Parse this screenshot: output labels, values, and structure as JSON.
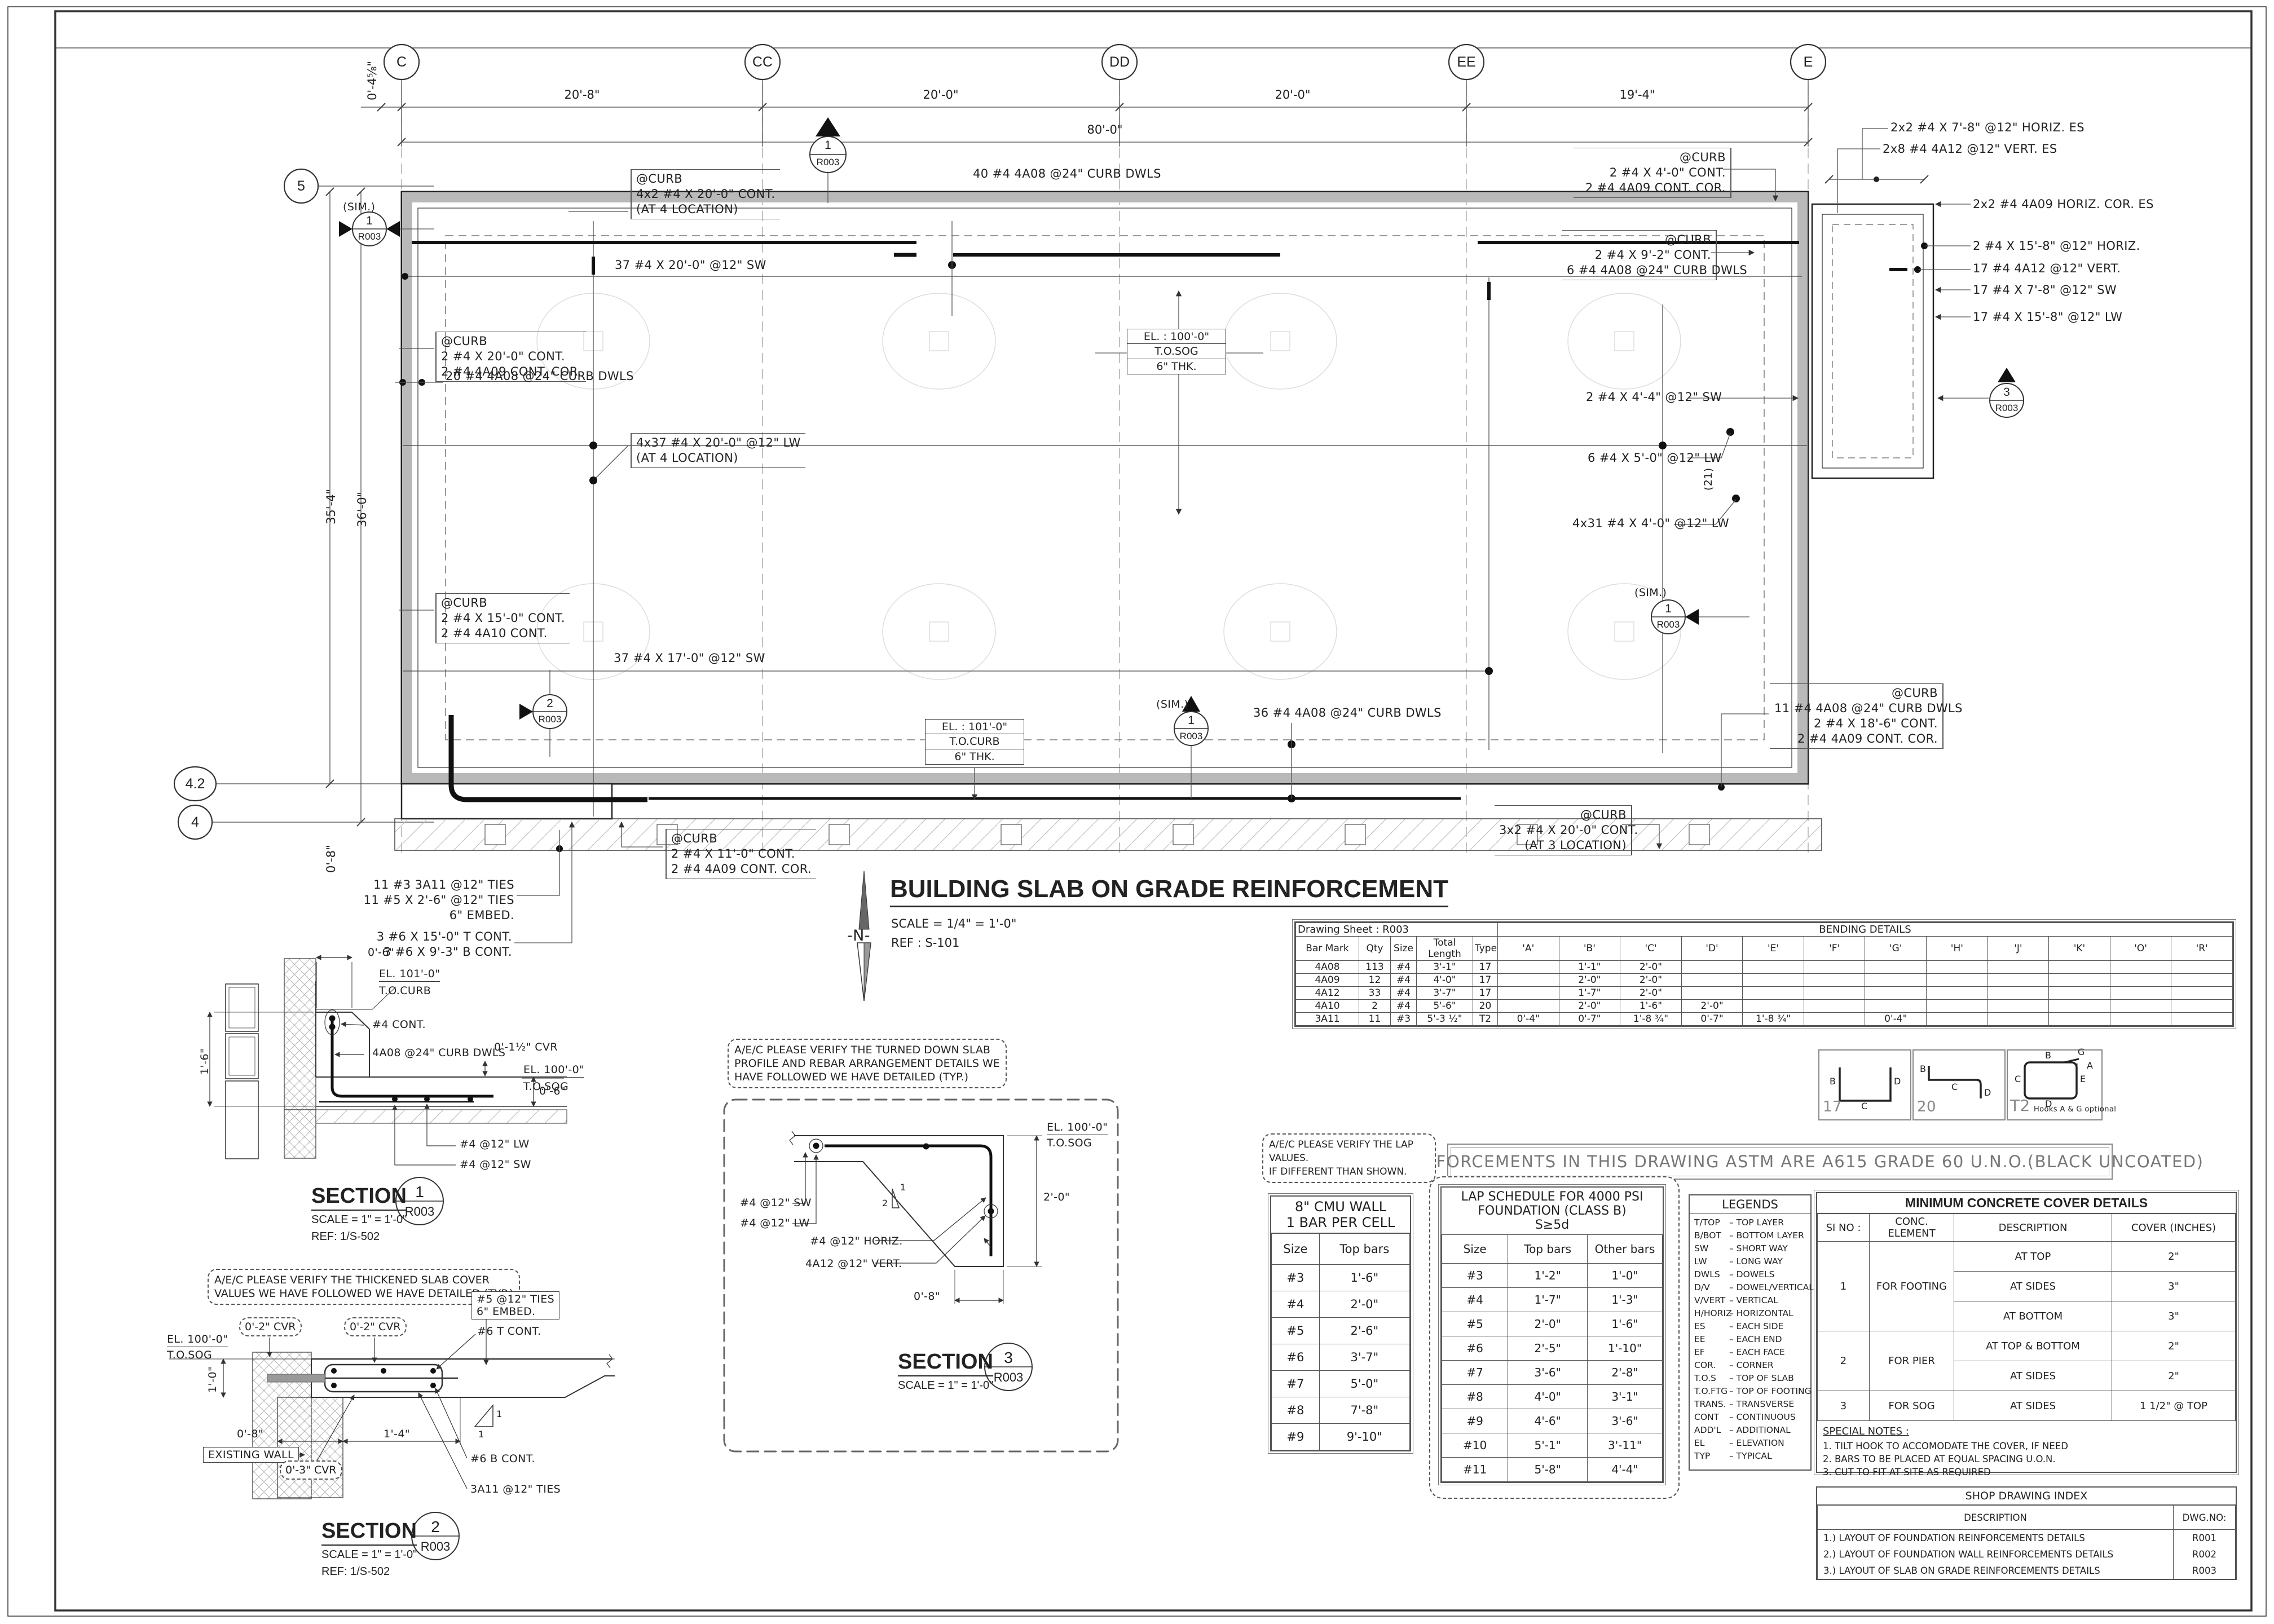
{
  "colors": {
    "curb_gray": "#b9b9b9",
    "hatch": "#aaaaaa",
    "line": "#222222"
  },
  "sheet": {
    "grid_top": [
      "C",
      "CC",
      "DD",
      "EE",
      "E"
    ],
    "grid_left": [
      "5",
      "4.2",
      "4"
    ],
    "dims_top": {
      "d0": "0'-4⅝\"",
      "d1": "20'-8\"",
      "d2": "20'-0\"",
      "d3": "20'-0\"",
      "d4": "19'-4\"",
      "overall": "80'-0\""
    },
    "dims_left": {
      "d1": "35'-4\"",
      "d2": "36'-0\"",
      "d3": "0'-8\""
    }
  },
  "plan": {
    "title": "BUILDING SLAB ON GRADE REINFORCEMENT",
    "scale": "SCALE = 1/4\" = 1'-0\"",
    "ref": "REF : S-101",
    "north": "-N-",
    "sim": "(SIM.)",
    "rot21": "(21)",
    "flag": {
      "n1": "1",
      "n2": "2",
      "n3": "3",
      "sheet": "R003"
    },
    "el_sog": {
      "l1": "EL. : 100'-0\"",
      "l2": "T.O.SOG",
      "l3": "6\" THK."
    },
    "el_curb": {
      "l1": "EL. : 101'-0\"",
      "l2": "T.O.CURB",
      "l3": "6\" THK."
    },
    "notes": {
      "curb_tl": {
        "lines": [
          "@CURB",
          "4x2 #4 X 20'-0\" CONT.",
          "(AT 4 LOCATION)"
        ]
      },
      "dwls_top": "40 #4 4A08 @24\" CURB DWLS",
      "curb_tr": {
        "lines": [
          "@CURB",
          "2 #4 X 4'-0\" CONT.",
          "2 #4 4A09 CONT. COR."
        ]
      },
      "horiz_es": "2x2 #4 X 7'-8\" @12\" HORIZ. ES",
      "vert_es": "2x8 #4 4A12 @12\" VERT. ES",
      "cor_es": "2x2 #4 4A09  HORIZ. COR. ES",
      "horiz2": "2 #4 X 15'-8\" @12\" HORIZ.",
      "vert17": "17 #4 4A12 @12\" VERT.",
      "sw17": "17 #4 X 7'-8\"  @12\" SW",
      "lw17": "17 #4 X 15'-8\"  @12\" LW",
      "curb_r": {
        "lines": [
          "@CURB",
          "2 #4 X 9'-2\"  CONT.",
          "6 #4 4A08 @24\" CURB DWLS"
        ]
      },
      "sw2": "2 #4 X 4'-4\"  @12\" SW",
      "lw6": "6 #4 X 5'-0\" @12\" LW",
      "lw4x31": "4x31 #4 X 4'-0\" @12\" LW",
      "curb_l1": {
        "lines": [
          "@CURB",
          "2 #4 X 20'-0\"  CONT.",
          "2 #4 4A09  CONT. COR."
        ]
      },
      "dwls_l": "20 #4 4A08 @24\" CURB DWLS",
      "lw4x37": {
        "lines": [
          "4x37 #4 X 20'-0\"  @12\" LW",
          "(AT 4 LOCATION)"
        ]
      },
      "curb_l2": {
        "lines": [
          "@CURB",
          "2 #4 X 15'-0\"  CONT.",
          "2 #4 4A10  CONT."
        ]
      },
      "sw37a": "37 #4 X 20'-0\"  @12\" SW",
      "sw37b": "37 #4 X 17'-0\"  @12\" SW",
      "dwls_b": "36 #4 4A08 @24\" CURB DWLS",
      "curb_br": {
        "lines": [
          "@CURB",
          "11 #4 4A08 @24\" CURB DWLS",
          "2 #4 X 18'-6\"  CONT.",
          "2 #4 4A09  CONT. COR."
        ]
      },
      "curb_bb": {
        "lines": [
          "@CURB",
          "3x2 #4 X 20'-0\"  CONT.",
          "(AT 3 LOCATION)"
        ]
      },
      "curb_bl": {
        "lines": [
          "@CURB",
          "2 #4 X 11'-0\"  CONT.",
          "2 #4 4A09  CONT. COR."
        ]
      },
      "ties_bl": {
        "lines": [
          "11 #3 3A11 @12\" TIES",
          "11 #5 X 2'-6\" @12\" TIES",
          "6\" EMBED."
        ]
      },
      "cont_bl": {
        "lines": [
          "3 #6 X 15'-0\"  T CONT.",
          "3 #6 X 9'-3\"  B CONT."
        ]
      }
    }
  },
  "bending": {
    "sheet_label": "Drawing Sheet : R003",
    "title": "BENDING DETAILS",
    "headers": [
      "Bar Mark",
      "Qty",
      "Size",
      "Total Length",
      "Type",
      "'A'",
      "'B'",
      "'C'",
      "'D'",
      "'E'",
      "'F'",
      "'G'",
      "'H'",
      "'J'",
      "'K'",
      "'O'",
      "'R'"
    ],
    "rows": [
      [
        "4A08",
        "113",
        "#4",
        "3'-1\"",
        "17",
        "",
        "1'-1\"",
        "2'-0\"",
        "",
        "",
        "",
        "",
        "",
        "",
        "",
        "",
        ""
      ],
      [
        "4A09",
        "12",
        "#4",
        "4'-0\"",
        "17",
        "",
        "2'-0\"",
        "2'-0\"",
        "",
        "",
        "",
        "",
        "",
        "",
        "",
        "",
        ""
      ],
      [
        "4A12",
        "33",
        "#4",
        "3'-7\"",
        "17",
        "",
        "1'-7\"",
        "2'-0\"",
        "",
        "",
        "",
        "",
        "",
        "",
        "",
        "",
        ""
      ],
      [
        "4A10",
        "2",
        "#4",
        "5'-6\"",
        "20",
        "",
        "2'-0\"",
        "1'-6\"",
        "2'-0\"",
        "",
        "",
        "",
        "",
        "",
        "",
        "",
        ""
      ],
      [
        "3A11",
        "11",
        "#3",
        "5'-3 ½\"",
        "T2",
        "0'-4\"",
        "0'-7\"",
        "1'-8 ¾\"",
        "0'-7\"",
        "1'-8 ¾\"",
        "",
        "0'-4\"",
        "",
        "",
        "",
        "",
        ""
      ]
    ]
  },
  "bend_types": {
    "n17": "17",
    "n20": "20",
    "nT2": "T2",
    "t2_note": "Hooks A & G optional",
    "A": "A",
    "B": "B",
    "C": "C",
    "D": "D",
    "E": "E",
    "G": "G"
  },
  "banner": "ALL REINFORCEMENTS IN THIS DRAWING  ASTM ARE A615 GRADE 60 U.N.O.(BLACK UNCOATED)",
  "cloud_lap": {
    "lines": [
      "A/E/C PLEASE VERIFY THE LAP VALUES.",
      "IF DIFFERENT THAN SHOWN."
    ]
  },
  "cmu": {
    "title1": "8\" CMU WALL",
    "title2": "1 BAR PER CELL",
    "headers": [
      "Size",
      "Top bars"
    ],
    "rows": [
      [
        "#3",
        "1'-6\""
      ],
      [
        "#4",
        "2'-0\""
      ],
      [
        "#5",
        "2'-6\""
      ],
      [
        "#6",
        "3'-7\""
      ],
      [
        "#7",
        "5'-0\""
      ],
      [
        "#8",
        "7'-8\""
      ],
      [
        "#9",
        "9'-10\""
      ]
    ]
  },
  "lap": {
    "title1": "LAP SCHEDULE FOR 4000 PSI",
    "title2": "FOUNDATION (CLASS B)",
    "title3": "S≥5d",
    "headers": [
      "Size",
      "Top bars",
      "Other bars"
    ],
    "rows": [
      [
        "#3",
        "1'-2\"",
        "1'-0\""
      ],
      [
        "#4",
        "1'-7\"",
        "1'-3\""
      ],
      [
        "#5",
        "2'-0\"",
        "1'-6\""
      ],
      [
        "#6",
        "2'-5\"",
        "1'-10\""
      ],
      [
        "#7",
        "3'-6\"",
        "2'-8\""
      ],
      [
        "#8",
        "4'-0\"",
        "3'-1\""
      ],
      [
        "#9",
        "4'-6\"",
        "3'-6\""
      ],
      [
        "#10",
        "5'-1\"",
        "3'-11\""
      ],
      [
        "#11",
        "5'-8\"",
        "4'-4\""
      ]
    ]
  },
  "legends": {
    "title": "LEGENDS",
    "items": [
      {
        "a": "T/TOP",
        "d": "–  TOP LAYER"
      },
      {
        "a": "B/BOT",
        "d": "–  BOTTOM LAYER"
      },
      {
        "a": "SW",
        "d": "–  SHORT WAY"
      },
      {
        "a": "LW",
        "d": "–  LONG WAY"
      },
      {
        "a": "DWLS",
        "d": "–  DOWELS"
      },
      {
        "a": "D/V",
        "d": "–  DOWEL/VERTICAL"
      },
      {
        "a": "V/VERT",
        "d": "–  VERTICAL"
      },
      {
        "a": "H/HORIZ",
        "d": "–  HORIZONTAL"
      },
      {
        "a": "ES",
        "d": "–  EACH SIDE"
      },
      {
        "a": "EE",
        "d": "–  EACH END"
      },
      {
        "a": "EF",
        "d": "–  EACH FACE"
      },
      {
        "a": "COR.",
        "d": "–  CORNER"
      },
      {
        "a": "T.O.S",
        "d": "–  TOP OF SLAB"
      },
      {
        "a": "T.O.FTG",
        "d": "–  TOP OF FOOTING"
      },
      {
        "a": "TRANS.",
        "d": "–  TRANSVERSE"
      },
      {
        "a": "CONT",
        "d": "–  CONTINUOUS"
      },
      {
        "a": "ADD'L",
        "d": "–  ADDITIONAL"
      },
      {
        "a": "EL",
        "d": "–  ELEVATION"
      },
      {
        "a": "TYP",
        "d": "–  TYPICAL"
      }
    ]
  },
  "cover": {
    "title": "MINIMUM CONCRETE COVER DETAILS",
    "headers": [
      "SI NO :",
      "CONC. ELEMENT",
      "DESCRIPTION",
      "COVER (INCHES)"
    ],
    "g1": {
      "no": "1",
      "el": "FOR FOOTING",
      "r1d": "AT TOP",
      "r1v": "2\"",
      "r2d": "AT SIDES",
      "r2v": "3\"",
      "r3d": "AT BOTTOM",
      "r3v": "3\""
    },
    "g2": {
      "no": "2",
      "el": "FOR PIER",
      "r1d": "AT TOP & BOTTOM",
      "r1v": "2\"",
      "r2d": "AT SIDES",
      "r2v": "2\""
    },
    "g3": {
      "no": "3",
      "el": "FOR SOG",
      "r1d": "AT SIDES",
      "r1v": "1 1/2\" @ TOP"
    },
    "special_title": "SPECIAL NOTES :",
    "notes": [
      "1. TILT HOOK TO ACCOMODATE THE COVER, IF NEED",
      "2. BARS TO BE PLACED AT EQUAL SPACING U.O.N.",
      "3. CUT TO FIT AT SITE AS REQUIRED"
    ]
  },
  "shop": {
    "title": "SHOP DRAWING INDEX",
    "headers": [
      "DESCRIPTION",
      "DWG.NO:"
    ],
    "rows": [
      [
        "1.) LAYOUT OF FOUNDATION REINFORCEMENTS DETAILS",
        "R001"
      ],
      [
        "2.) LAYOUT OF FOUNDATION WALL REINFORCEMENTS DETAILS",
        "R002"
      ],
      [
        "3.) LAYOUT OF SLAB ON GRADE REINFORCEMENTS DETAILS",
        "R003"
      ]
    ]
  },
  "section1": {
    "title": "SECTION",
    "num": "1",
    "sheet": "R003",
    "scale": "SCALE = 1\" = 1'-0\"",
    "ref": "REF: 1/S-502",
    "dim_top": "0'-6\"",
    "el_curb1": "EL. 101'-0\"",
    "el_curb2": "T.O.CURB",
    "bar": "#4  CONT.",
    "dwls": "4A08 @24\" CURB DWLS",
    "cvr": "0'-1½\" CVR",
    "el_sog1": "EL. 100'-0\"",
    "el_sog2": "T.O.SOG",
    "dim_r": "0'-6\"",
    "dim_l": "1'-6\"",
    "lw": "#4  @12\" LW",
    "sw": "#4  @12\" SW"
  },
  "section2": {
    "title": "SECTION",
    "num": "2",
    "sheet": "R003",
    "scale": "SCALE = 1\" = 1'-0\"",
    "ref": "REF: 1/S-502",
    "cloud": {
      "lines": [
        "A/E/C PLEASE VERIFY THE THICKENED SLAB COVER",
        "VALUES WE HAVE FOLLOWED WE HAVE DETAILED (TYP.)"
      ]
    },
    "ties": {
      "lines": [
        "#5 @12\" TIES",
        "6\" EMBED."
      ]
    },
    "tcont": "#6  T CONT.",
    "el1": "EL. 100'-0\"",
    "el2": "T.O.SOG",
    "dim_h": "1'-0\"",
    "cvra": "0'-2\" CVR",
    "cvrb": "0'-2\" CVR",
    "cvrc": "0'-3\" CVR",
    "dim_a": "0'-8\"",
    "dim_b": "1'-4\"",
    "wall": "EXISTING WALL",
    "bcont": "#6  B CONT.",
    "ties2": "3A11 @12\" TIES",
    "slope1": "1",
    "slope2": "1"
  },
  "section3": {
    "title": "SECTION",
    "num": "3",
    "sheet": "R003",
    "scale": "SCALE = 1\" = 1'-0\"",
    "cloud": {
      "lines": [
        "A/E/C PLEASE VERIFY THE TURNED DOWN SLAB",
        "PROFILE AND REBAR ARRANGEMENT DETAILS WE",
        "HAVE FOLLOWED WE HAVE DETAILED (TYP.)"
      ]
    },
    "el1": "EL. 100'-0\"",
    "el2": "T.O.SOG",
    "sw": "#4  @12\" SW",
    "lw": "#4  @12\" LW",
    "horiz": "#4 @12\" HORIZ.",
    "vert": "4A12 @12\" VERT.",
    "dim_v": "2'-0\"",
    "dim_b": "0'-8\"",
    "slope1": "1",
    "slope2": "2"
  }
}
